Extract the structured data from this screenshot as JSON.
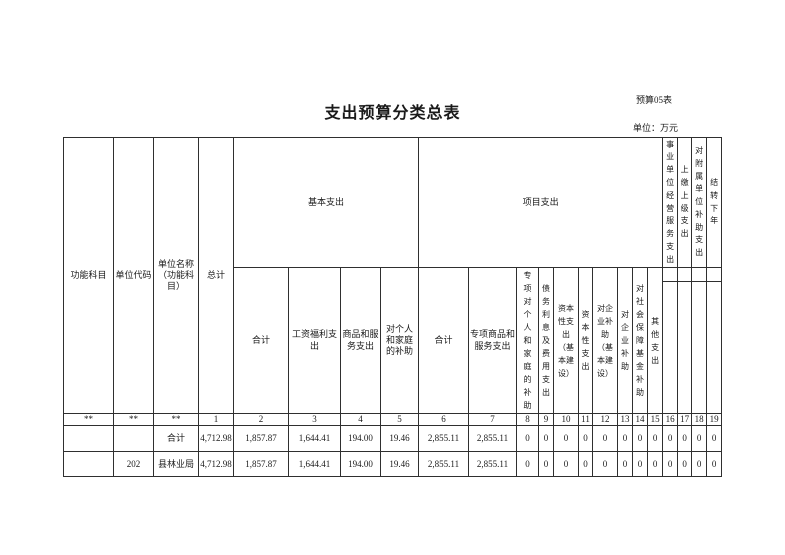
{
  "page": {
    "sheet_label": "预算05表",
    "title": "支出预算分类总表",
    "unit_label": "单位：万元"
  },
  "table": {
    "header": {
      "function_subject": "功能科目",
      "unit_code": "单位代码",
      "unit_name": "单位名称（功能科目）",
      "grand_total": "总计",
      "basic_group": "基本支出",
      "project_group": "项目支出",
      "basic_cols": [
        "合计",
        "工资福利支出",
        "商品和服务支出",
        "对个人和家庭的补助"
      ],
      "project_cols": [
        "合计",
        "专项商品和服务支出",
        "专项对个人和家庭的补助",
        "债务利息及费用支出",
        "资本性支出（基本建设）",
        "资本性支出",
        "对企业补助（基本建设）",
        "对企业补助",
        "对社会保障基金补助",
        "其他支出"
      ],
      "tail_cols": [
        "事业单位经营服务支出",
        "上缴上级支出",
        "对附属单位补助支出",
        "结转下年"
      ]
    },
    "colnum_row": [
      "**",
      "**",
      "**",
      "1",
      "2",
      "3",
      "4",
      "5",
      "6",
      "7",
      "8",
      "9",
      "10",
      "11",
      "12",
      "13",
      "14",
      "15",
      "16",
      "17",
      "18",
      "19"
    ],
    "rows": [
      {
        "function_subject": "",
        "unit_code": "",
        "unit_name": "合计",
        "values": [
          "4,712.98",
          "1,857.87",
          "1,644.41",
          "194.00",
          "19.46",
          "2,855.11",
          "2,855.11",
          "0",
          "0",
          "0",
          "0",
          "0",
          "0",
          "0",
          "0",
          "0",
          "0",
          "0",
          "0"
        ]
      },
      {
        "function_subject": "",
        "unit_code": "202",
        "unit_name": "县林业局",
        "values": [
          "4,712.98",
          "1,857.87",
          "1,644.41",
          "194.00",
          "19.46",
          "2,855.11",
          "2,855.11",
          "0",
          "0",
          "0",
          "0",
          "0",
          "0",
          "0",
          "0",
          "0",
          "0",
          "0",
          "0"
        ]
      }
    ]
  }
}
